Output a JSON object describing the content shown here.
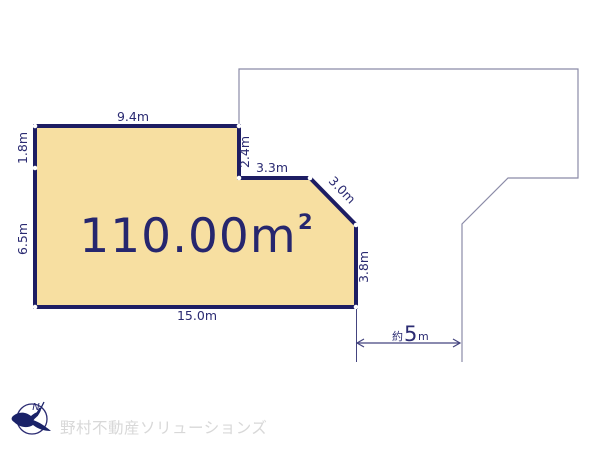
{
  "plot": {
    "area_value": "110.00m",
    "area_superscript": "2",
    "fill_color": "#F7DFA1",
    "border_color": "#1D1D63"
  },
  "dimensions": {
    "top": "9.4m",
    "left_upper": "1.8m",
    "left_lower": "6.5m",
    "notch_vertical": "2.4m",
    "notch_horizontal": "3.3m",
    "diagonal": "3.0m",
    "right": "3.8m",
    "bottom": "15.0m"
  },
  "road": {
    "prefix": "約",
    "value": "5",
    "unit": "m"
  },
  "compass": {
    "label": "N"
  },
  "watermark": {
    "company": "野村不動産ソリューションズ"
  },
  "colors": {
    "plot_fill": "#F7DFA1",
    "plot_border": "#1D1D63",
    "label_text": "#2B2B72",
    "adjacent_outline": "#8B8BA8",
    "dimension_line": "#44447F",
    "watermark_text": "#D8D8D8",
    "background": "#FFFFFF"
  }
}
